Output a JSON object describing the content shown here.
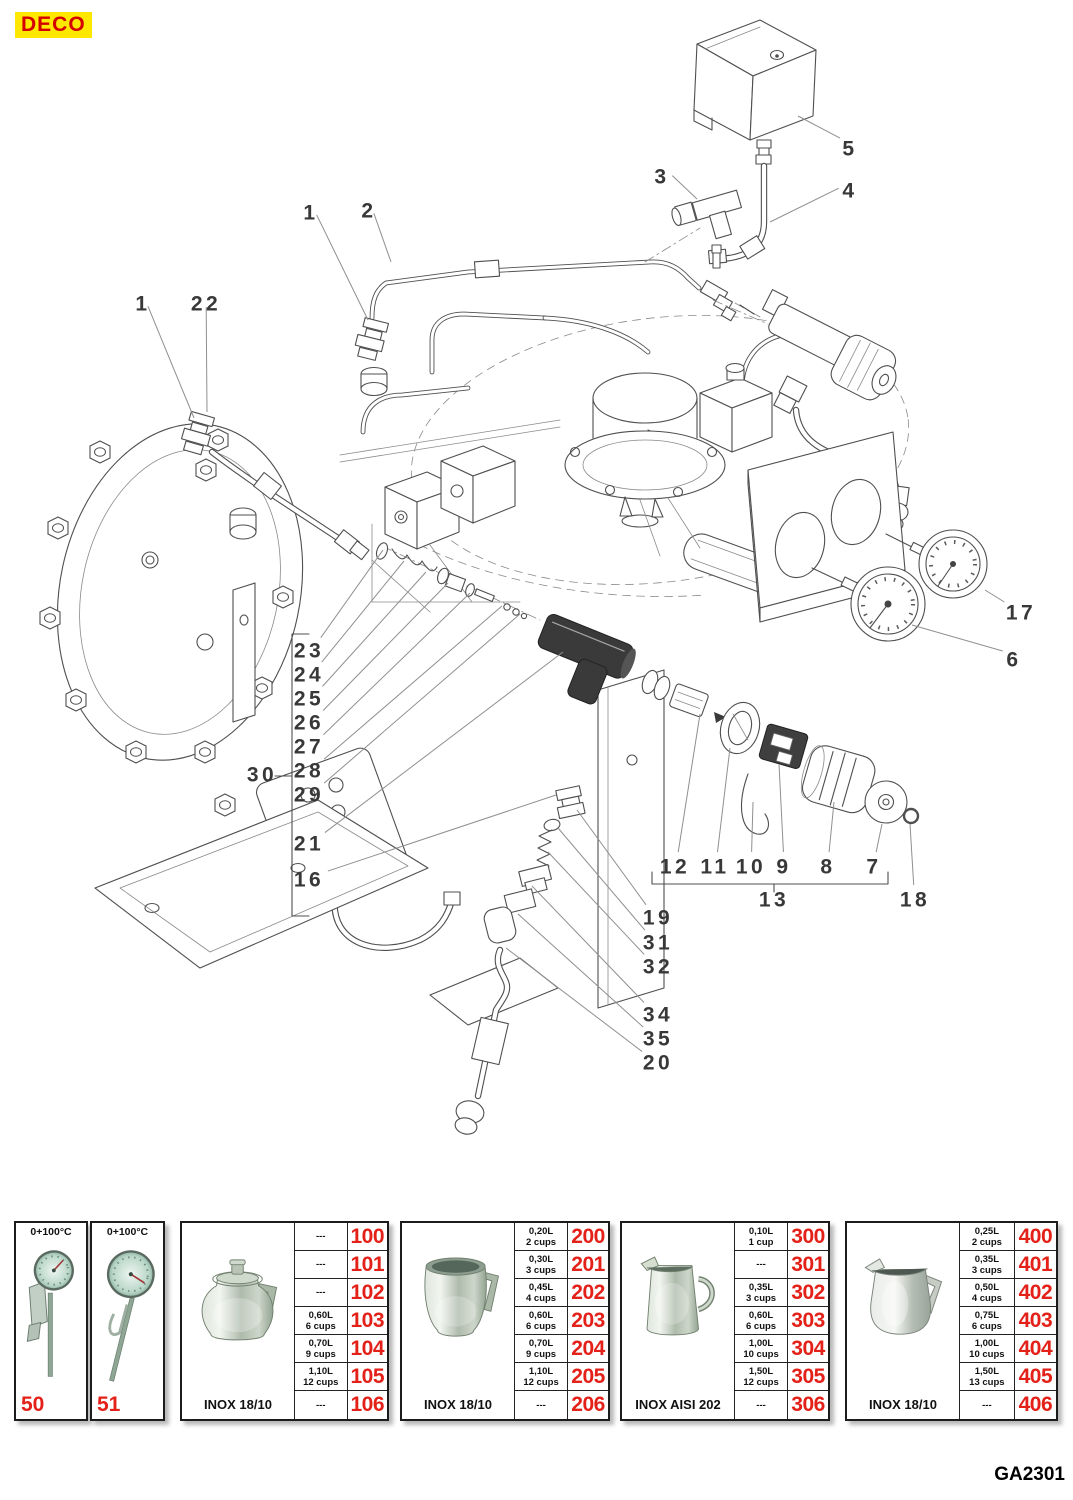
{
  "page": {
    "brand": "DECO",
    "code": "GA2301"
  },
  "diagram": {
    "callouts": [
      {
        "label": "1",
        "x": 143,
        "y": 305,
        "tx": 194,
        "ty": 418
      },
      {
        "label": "22",
        "x": 206,
        "y": 305,
        "tx": 207,
        "ty": 412
      },
      {
        "label": "1",
        "x": 311,
        "y": 214,
        "tx": 368,
        "ty": 320
      },
      {
        "label": "2",
        "x": 369,
        "y": 212,
        "tx": 391,
        "ty": 262
      },
      {
        "label": "3",
        "x": 662,
        "y": 178,
        "tx": 697,
        "ty": 199
      },
      {
        "label": "4",
        "x": 850,
        "y": 192,
        "tx": 770,
        "ty": 222
      },
      {
        "label": "5",
        "x": 850,
        "y": 150,
        "tx": 798,
        "ty": 116
      },
      {
        "label": "17",
        "x": 1021,
        "y": 614,
        "tx": 985,
        "ty": 590
      },
      {
        "label": "6",
        "x": 1014,
        "y": 661,
        "tx": 912,
        "ty": 625
      },
      {
        "label": "23",
        "x": 309,
        "y": 652,
        "tx": 383,
        "ty": 550
      },
      {
        "label": "24",
        "x": 309,
        "y": 676,
        "tx": 404,
        "ty": 561
      },
      {
        "label": "25",
        "x": 309,
        "y": 700,
        "tx": 426,
        "ty": 572
      },
      {
        "label": "26",
        "x": 309,
        "y": 724,
        "tx": 448,
        "ty": 583
      },
      {
        "label": "27",
        "x": 309,
        "y": 748,
        "tx": 470,
        "ty": 593
      },
      {
        "label": "28",
        "x": 309,
        "y": 772,
        "tx": 502,
        "ty": 606
      },
      {
        "label": "29",
        "x": 309,
        "y": 796,
        "tx": 520,
        "ty": 614
      },
      {
        "label": "30",
        "x": 262,
        "y": 776
      },
      {
        "label": "21",
        "x": 309,
        "y": 845,
        "tx": 563,
        "ty": 652
      },
      {
        "label": "16",
        "x": 309,
        "y": 881,
        "tx": 556,
        "ty": 795
      },
      {
        "label": "12",
        "x": 675,
        "y": 868,
        "tx": 700,
        "ty": 714
      },
      {
        "label": "11",
        "x": 715,
        "y": 868,
        "tx": 730,
        "ty": 748
      },
      {
        "label": "10",
        "x": 751,
        "y": 868,
        "tx": 753,
        "ty": 802
      },
      {
        "label": "9",
        "x": 784,
        "y": 868,
        "tx": 779,
        "ty": 764
      },
      {
        "label": "8",
        "x": 828,
        "y": 868,
        "tx": 834,
        "ty": 802
      },
      {
        "label": "7",
        "x": 874,
        "y": 868,
        "tx": 882,
        "ty": 824
      },
      {
        "label": "13",
        "x": 774,
        "y": 901
      },
      {
        "label": "18",
        "x": 915,
        "y": 901,
        "tx": 910,
        "ty": 824
      },
      {
        "label": "19",
        "x": 658,
        "y": 919,
        "tx": 577,
        "ty": 810
      },
      {
        "label": "31",
        "x": 658,
        "y": 944,
        "tx": 558,
        "ty": 828
      },
      {
        "label": "32",
        "x": 658,
        "y": 968,
        "tx": 548,
        "ty": 852
      },
      {
        "label": "34",
        "x": 658,
        "y": 1016,
        "tx": 532,
        "ty": 886
      },
      {
        "label": "35",
        "x": 658,
        "y": 1040,
        "tx": 518,
        "ty": 914
      },
      {
        "label": "20",
        "x": 658,
        "y": 1064,
        "tx": 506,
        "ty": 948
      }
    ]
  },
  "accessories": {
    "panels": [
      {
        "type": "thermometer",
        "range_label": "0+100°C",
        "number": "50"
      },
      {
        "type": "thermometer",
        "range_label": "0+100°C",
        "number": "51"
      },
      {
        "type": "jug",
        "caption": "INOX 18/10",
        "rows": [
          {
            "cap": "---",
            "cups": "",
            "num": "100"
          },
          {
            "cap": "---",
            "cups": "",
            "num": "101"
          },
          {
            "cap": "---",
            "cups": "",
            "num": "102"
          },
          {
            "cap": "0,60L",
            "cups": "6 cups",
            "num": "103"
          },
          {
            "cap": "0,70L",
            "cups": "9 cups",
            "num": "104"
          },
          {
            "cap": "1,10L",
            "cups": "12 cups",
            "num": "105"
          },
          {
            "cap": "---",
            "cups": "",
            "num": "106"
          }
        ]
      },
      {
        "type": "jug",
        "caption": "INOX 18/10",
        "rows": [
          {
            "cap": "0,20L",
            "cups": "2 cups",
            "num": "200"
          },
          {
            "cap": "0,30L",
            "cups": "3 cups",
            "num": "201"
          },
          {
            "cap": "0,45L",
            "cups": "4 cups",
            "num": "202"
          },
          {
            "cap": "0,60L",
            "cups": "6 cups",
            "num": "203"
          },
          {
            "cap": "0,70L",
            "cups": "9 cups",
            "num": "204"
          },
          {
            "cap": "1,10L",
            "cups": "12 cups",
            "num": "205"
          },
          {
            "cap": "---",
            "cups": "",
            "num": "206"
          }
        ]
      },
      {
        "type": "jug",
        "caption": "INOX AISI 202",
        "rows": [
          {
            "cap": "0,10L",
            "cups": "1 cup",
            "num": "300"
          },
          {
            "cap": "---",
            "cups": "",
            "num": "301"
          },
          {
            "cap": "0,35L",
            "cups": "3 cups",
            "num": "302"
          },
          {
            "cap": "0,60L",
            "cups": "6 cups",
            "num": "303"
          },
          {
            "cap": "1,00L",
            "cups": "10 cups",
            "num": "304"
          },
          {
            "cap": "1,50L",
            "cups": "12 cups",
            "num": "305"
          },
          {
            "cap": "---",
            "cups": "",
            "num": "306"
          }
        ]
      },
      {
        "type": "jug",
        "caption": "INOX 18/10",
        "rows": [
          {
            "cap": "0,25L",
            "cups": "2 cups",
            "num": "400"
          },
          {
            "cap": "0,35L",
            "cups": "3 cups",
            "num": "401"
          },
          {
            "cap": "0,50L",
            "cups": "4 cups",
            "num": "402"
          },
          {
            "cap": "0,75L",
            "cups": "6 cups",
            "num": "403"
          },
          {
            "cap": "1,00L",
            "cups": "10 cups",
            "num": "404"
          },
          {
            "cap": "1,50L",
            "cups": "13 cups",
            "num": "405"
          },
          {
            "cap": "---",
            "cups": "",
            "num": "406"
          }
        ]
      }
    ]
  }
}
